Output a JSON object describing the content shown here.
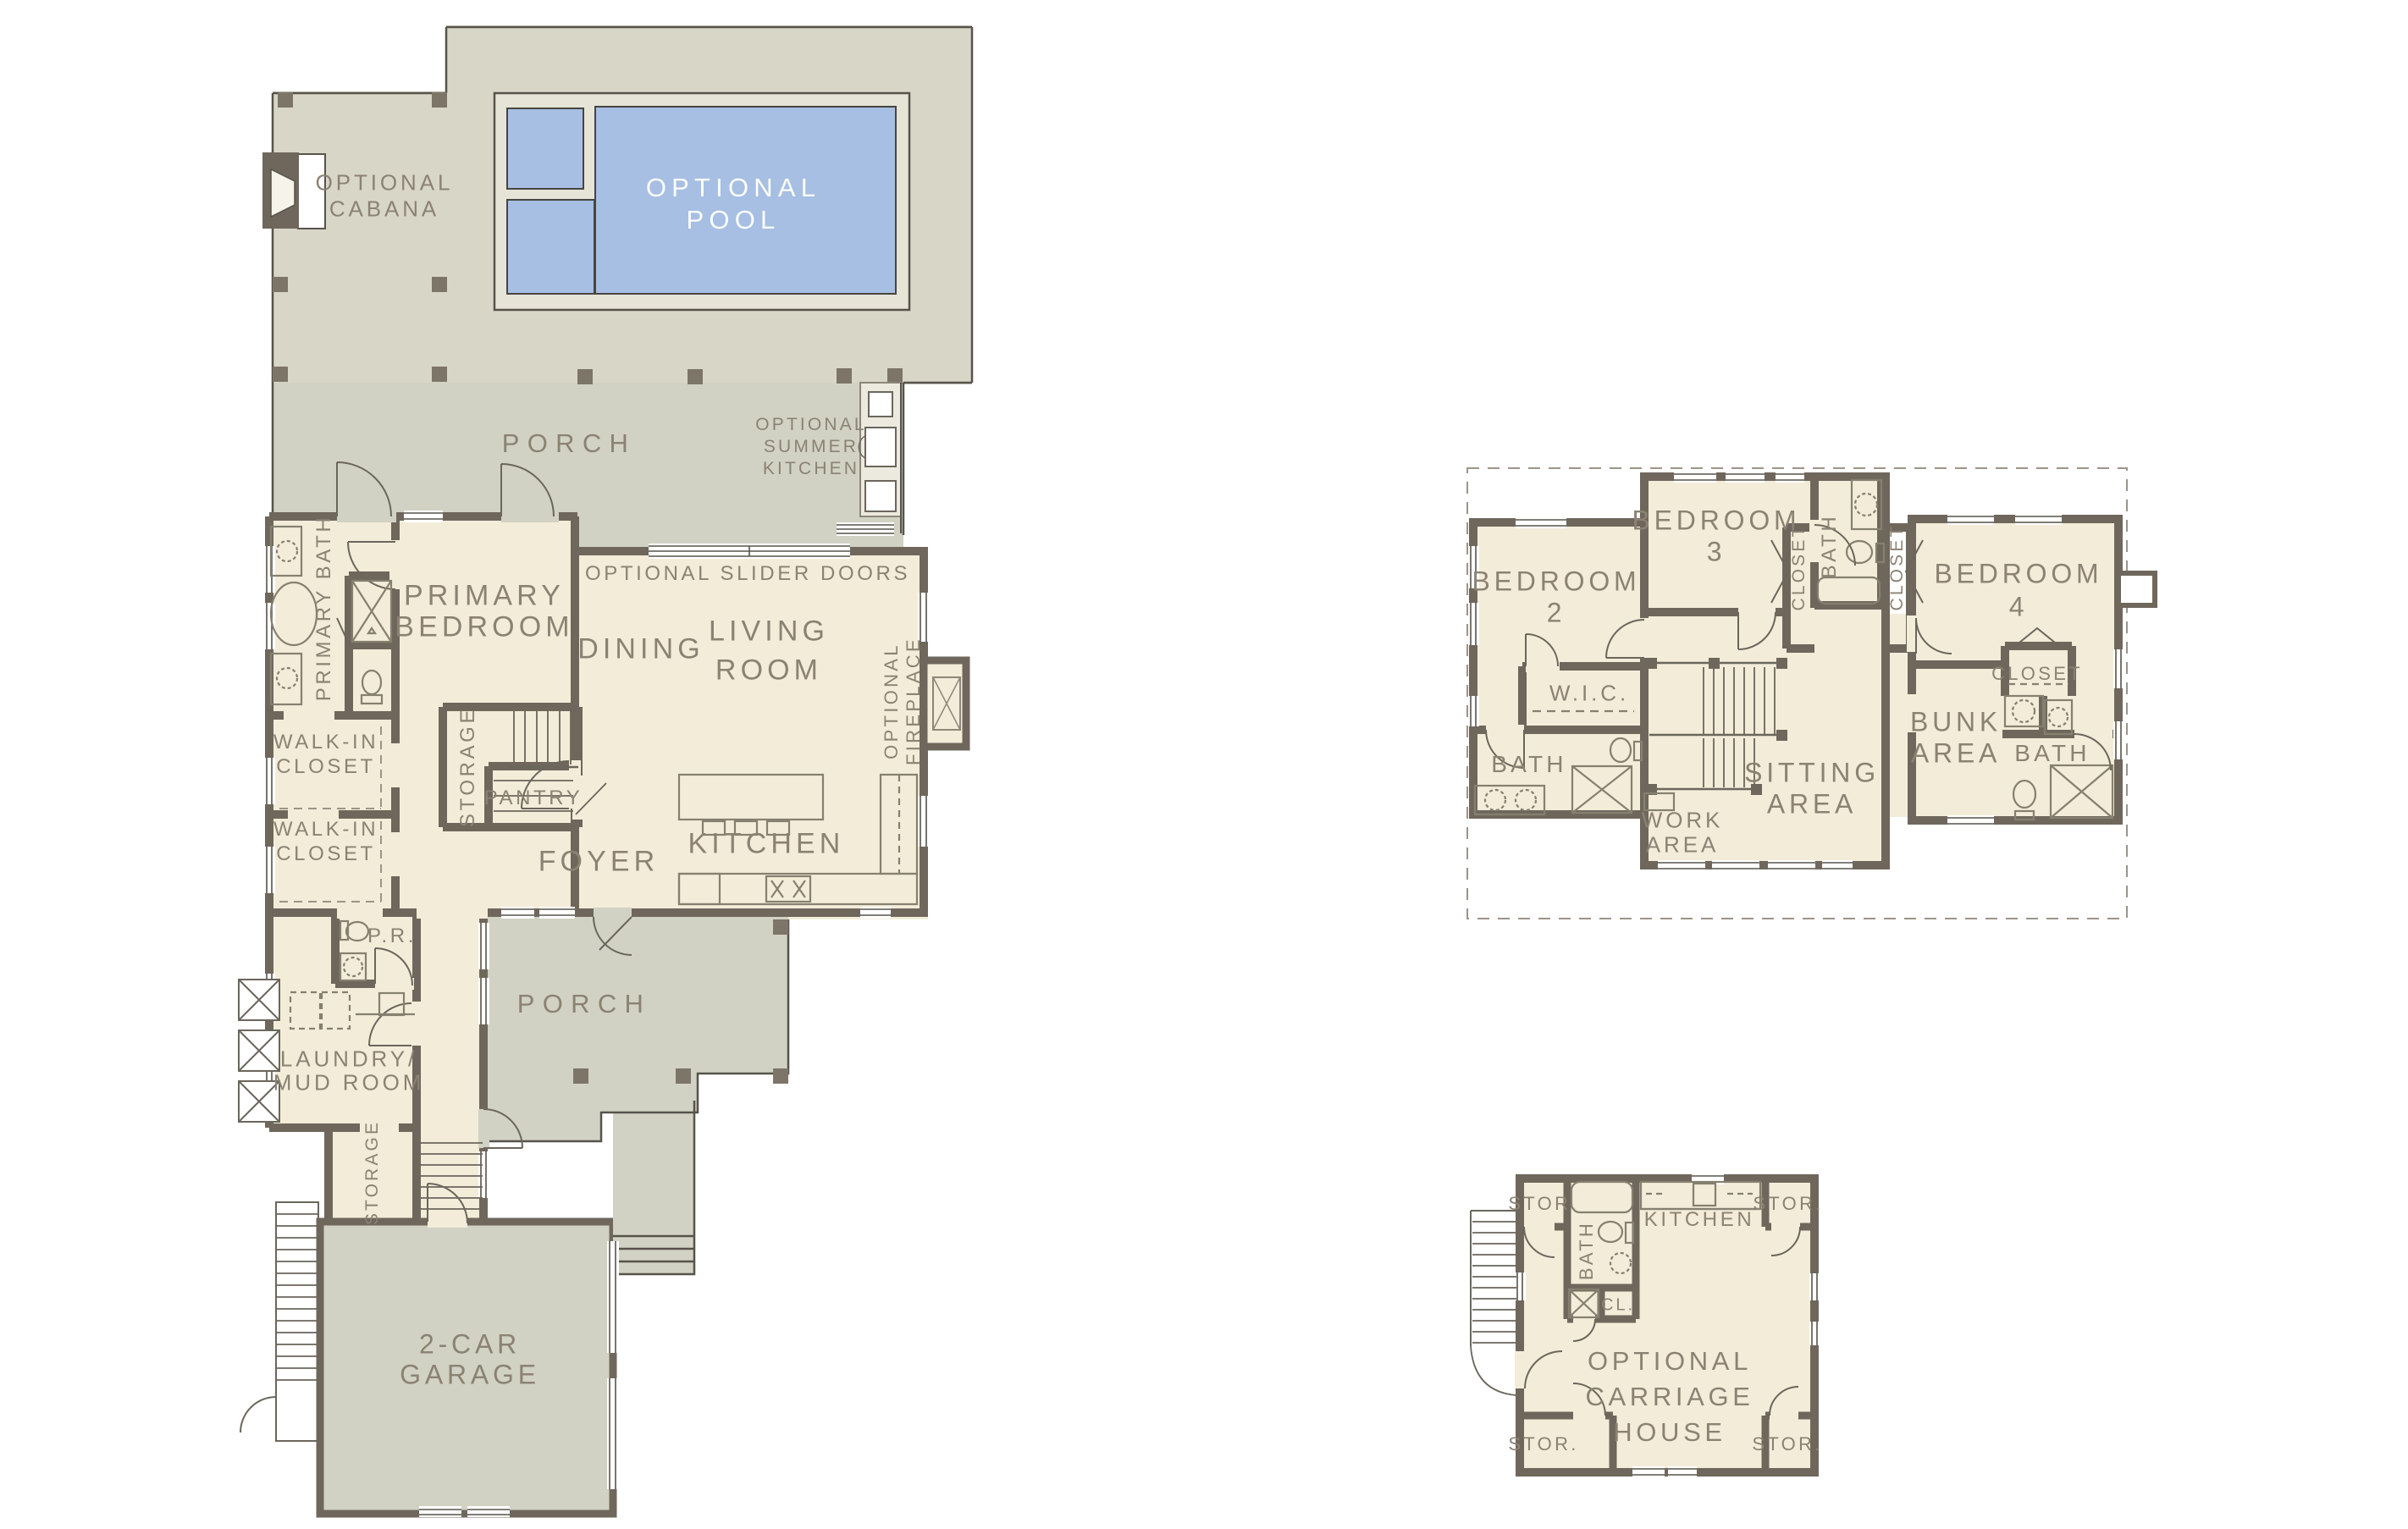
{
  "colors": {
    "pool_water": "#a6bfe3",
    "interior_cream": "#f3ecd9",
    "deck_gray": "#d8d6c7",
    "porch_gray": "#d1d2c3",
    "wall_taupe": "#6f675c",
    "label_gray": "#8b8273",
    "pool_text": "#fdfdfa"
  },
  "main_floor": {
    "cabana_line1": "OPTIONAL",
    "cabana_line2": "CABANA",
    "pool_line1": "OPTIONAL",
    "pool_line2": "POOL",
    "porch_upper": "PORCH",
    "summer_line1": "OPTIONAL",
    "summer_line2": "SUMMER",
    "summer_line3": "KITCHEN",
    "slider_doors": "OPTIONAL SLIDER DOORS",
    "primary_bath": "PRIMARY BATH",
    "primary_line1": "PRIMARY",
    "primary_line2": "BEDROOM",
    "dining": "DINING",
    "living_line1": "LIVING",
    "living_line2": "ROOM",
    "fireplace_line1": "OPTIONAL",
    "fireplace_line2": "FIREPLACE",
    "wic1_line1": "WALK-IN",
    "wic1_line2": "CLOSET",
    "wic2_line1": "WALK-IN",
    "wic2_line2": "CLOSET",
    "storage_hall": "STORAGE",
    "pantry": "PANTRY",
    "foyer": "FOYER",
    "kitchen": "KITCHEN",
    "powder_room": "P.R.",
    "laundry_line1": "LAUNDRY/",
    "laundry_line2": "MUD ROOM",
    "porch_rear": "PORCH",
    "storage_lower": "STORAGE",
    "garage_line1": "2-CAR",
    "garage_line2": "GARAGE"
  },
  "second_floor": {
    "bedroom2_line1": "BEDROOM",
    "bedroom2_line2": "2",
    "bedroom3_line1": "BEDROOM",
    "bedroom3_line2": "3",
    "bath_top": "BATH",
    "closet_left": "CLOSET",
    "closet_right": "CLOSET",
    "bedroom4_line1": "BEDROOM",
    "bedroom4_line2": "4",
    "wic": "W.I.C.",
    "bath_left": "BATH",
    "work_line1": "WORK",
    "work_line2": "AREA",
    "sitting_line1": "SITTING",
    "sitting_line2": "AREA",
    "bunk_line1": "BUNK",
    "bunk_line2": "AREA",
    "closet_b4": "CLOSET",
    "bath_right": "BATH"
  },
  "carriage_house": {
    "stor_tl": "STOR.",
    "stor_tr": "STOR.",
    "stor_bl": "STOR.",
    "stor_br": "STOR.",
    "bath": "BATH",
    "kitchen": "KITCHEN",
    "closet": "CL.",
    "name_line1": "OPTIONAL",
    "name_line2": "CARRIAGE",
    "name_line3": "HOUSE"
  }
}
